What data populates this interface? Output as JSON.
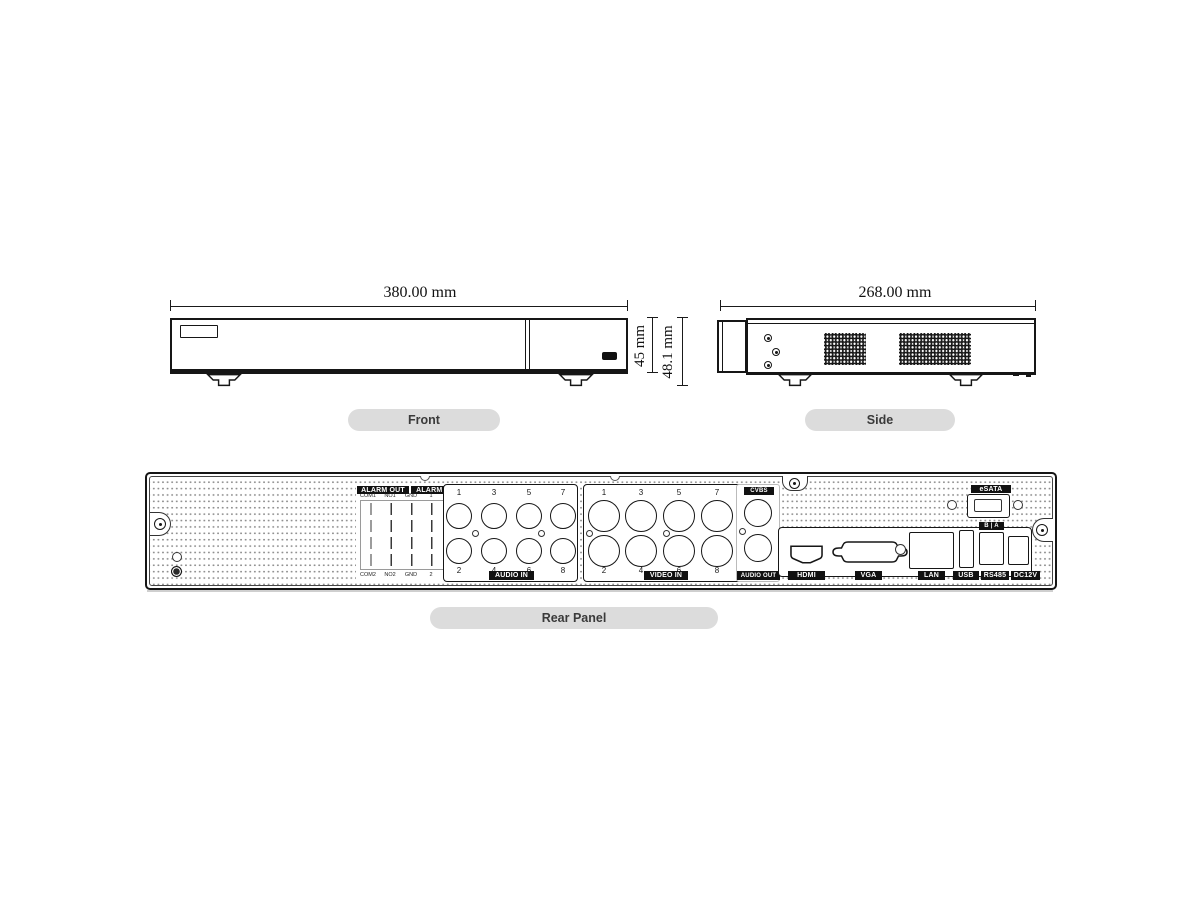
{
  "front_view": {
    "caption": "Front",
    "width_dimension": "380.00 mm",
    "body_height_dimension": "45 mm",
    "total_height_dimension": "48.1 mm"
  },
  "side_view": {
    "caption": "Side",
    "depth_dimension": "268.00 mm"
  },
  "rear_panel": {
    "caption": "Rear Panel",
    "alarm_out_label": "ALARM OUT",
    "alarm_in_label": "ALARM IN",
    "alarm_terminal_top_labels": [
      "COM1",
      "NO1",
      "GND",
      "1",
      "3",
      "5",
      "7"
    ],
    "alarm_terminal_bottom_labels": [
      "COM2",
      "NO2",
      "GND",
      "2",
      "4",
      "6",
      "8"
    ],
    "audio_in": {
      "label": "AUDIO IN",
      "top_jack_numbers": [
        "1",
        "3",
        "5",
        "7"
      ],
      "bottom_jack_numbers": [
        "2",
        "4",
        "6",
        "8"
      ]
    },
    "video_in": {
      "label": "VIDEO IN",
      "top_jack_numbers": [
        "1",
        "3",
        "5",
        "7"
      ],
      "bottom_jack_numbers": [
        "2",
        "4",
        "6",
        "8"
      ]
    },
    "cvbs_label": "CVBS",
    "audio_out_label": "AUDIO OUT",
    "esata_label": "eSATA",
    "rs485_terminal_label": "B | A",
    "port_labels": {
      "hdmi": "HDMI",
      "vga": "VGA",
      "lan": "LAN",
      "usb": "USB",
      "rs485": "RS485",
      "power": "DC12V"
    }
  },
  "colors": {
    "line": "#1a1a1a",
    "pill_bg": "#dcdcdc",
    "pill_text": "#3a3a3a",
    "chip_bg": "#111111",
    "chip_text": "#ffffff"
  }
}
